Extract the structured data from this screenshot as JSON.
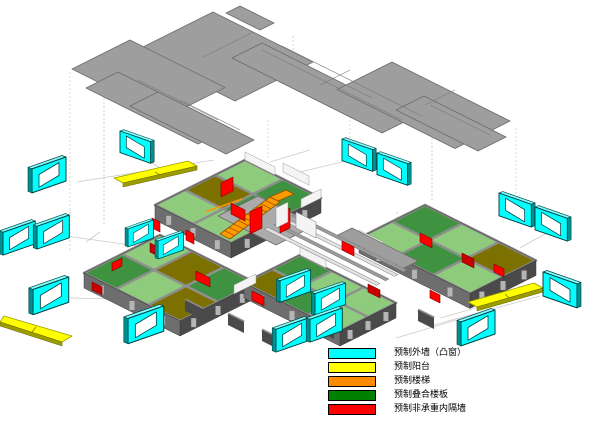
{
  "legend": {
    "items": [
      {
        "id": "precast-exterior-wall-bay-window",
        "label": "预制外墙（凸窗）",
        "color": "#00FFFF"
      },
      {
        "id": "precast-balcony",
        "label": "预制阳台",
        "color": "#FFFF00"
      },
      {
        "id": "precast-stair",
        "label": "预制楼梯",
        "color": "#FF8C00"
      },
      {
        "id": "precast-composite-floor-slab",
        "label": "预制叠合楼板",
        "color": "#008000"
      },
      {
        "id": "precast-nonbearing-partition",
        "label": "预制非承重内隔墙",
        "color": "#FF0000"
      }
    ]
  },
  "diagram": {
    "type": "exploded-axonometric-view",
    "colors": {
      "background": "#FFFFFF",
      "plate_gray": "#9E9E9E",
      "plate_edge": "#6E6E6E",
      "slab_green_light": "#8FCB7D",
      "slab_green": "#3F9340",
      "slab_olive": "#7C7000",
      "slab_edge": "#2E6E2F",
      "wall_gray": "#8F8F8F",
      "wall_face_dark": "#4A4A4A",
      "wall_face_mid": "#6E6E6E",
      "wall_pier": "#B5B5B5",
      "wall_white": "#F4F4F4",
      "window_cyan": "#00FFFF",
      "window_cyan_dark": "#008F8F",
      "window_cyan_light": "#80FFFF",
      "window_outline": "#004040",
      "balcony_yellow": "#FFFF00",
      "balcony_edge": "#9C9C00",
      "stair_orange": "#FF9900",
      "stair_outline": "#8A5200",
      "partition_red": "#FF0000",
      "partition_red_dark": "#C80000",
      "partition_outline": "#7A0000",
      "guide_line": "#CBCBCB",
      "legend_border": "#000000"
    }
  }
}
